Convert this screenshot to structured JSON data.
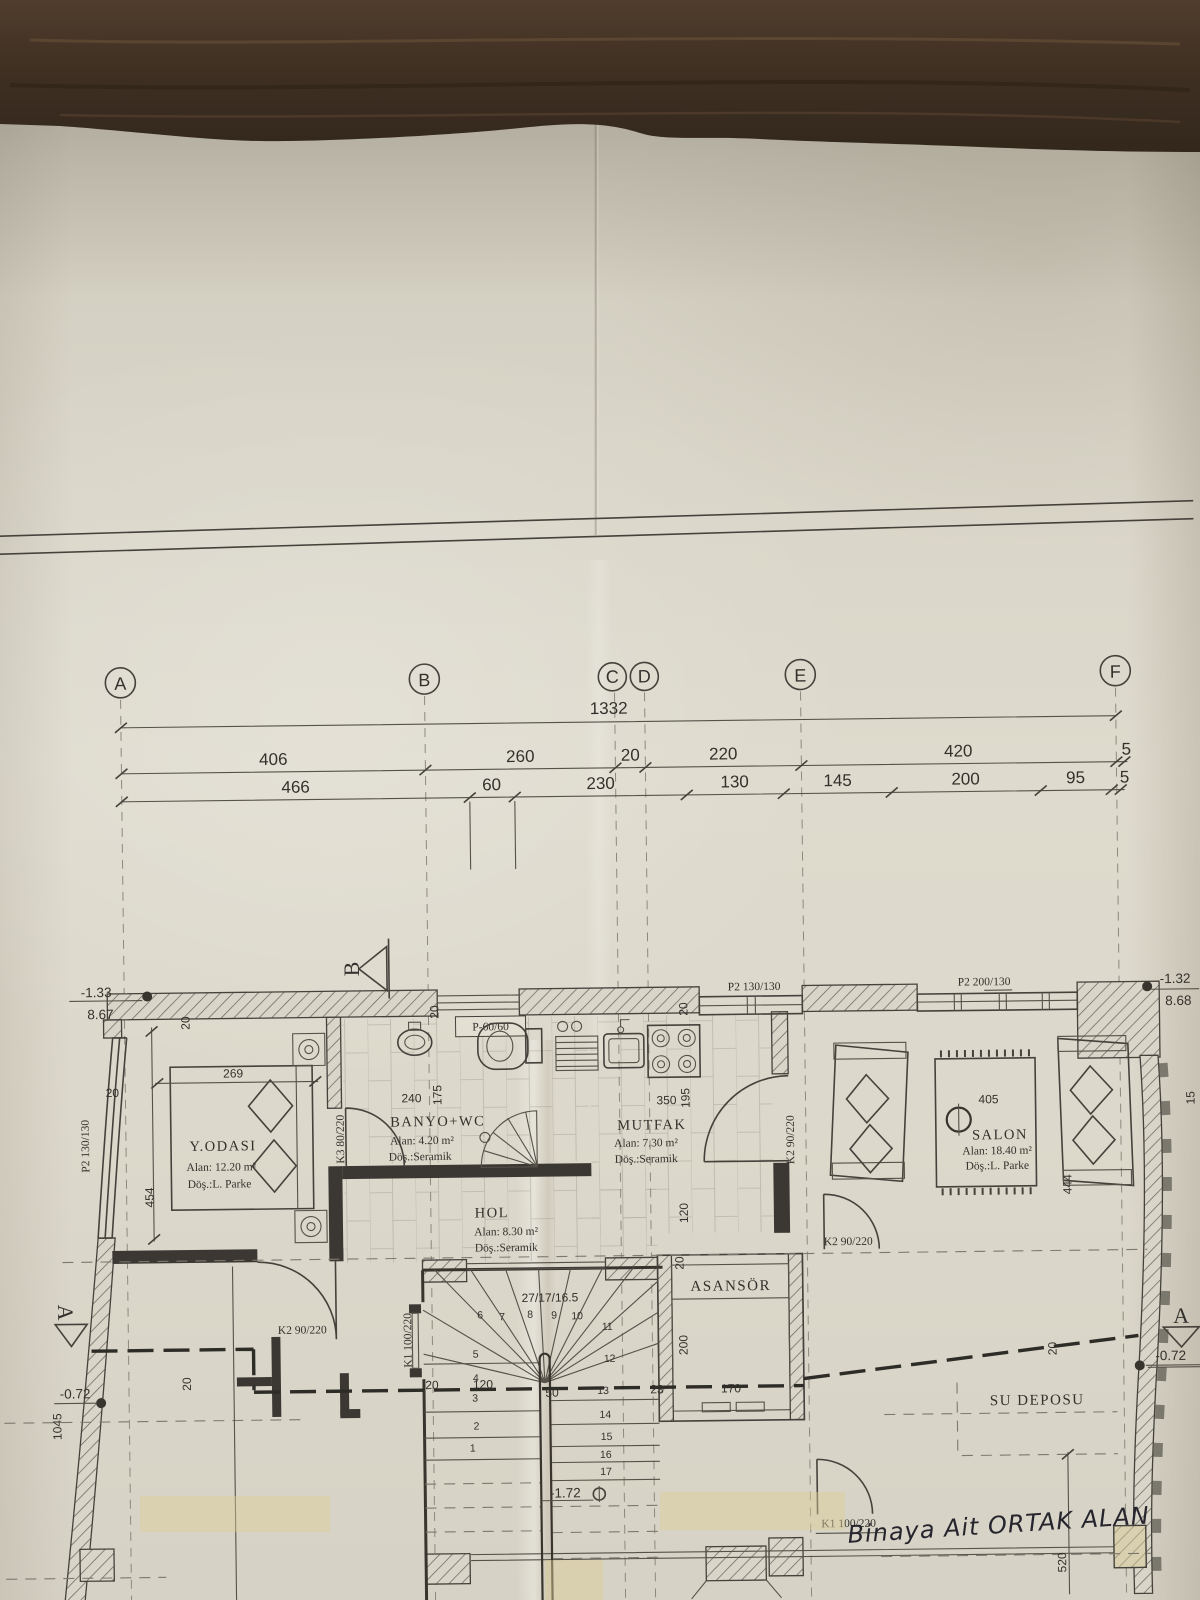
{
  "grid": {
    "axes": [
      "A",
      "B",
      "C",
      "D",
      "E",
      "F"
    ],
    "total": "1332",
    "row2": [
      "406",
      "260",
      "20",
      "220",
      "420",
      "5"
    ],
    "row3": [
      "466",
      "60",
      "230",
      "130",
      "145",
      "200",
      "95",
      "5"
    ]
  },
  "elevations": {
    "top_left_minus": "-1.33",
    "top_left_plus": "8.67",
    "top_right_minus": "-1.32",
    "top_right_plus": "8.68",
    "left": "-0.72",
    "right": "-0.72",
    "stair": "-1.72"
  },
  "sections": {
    "b": "B",
    "a_left": "A",
    "a_right": "A"
  },
  "rooms": {
    "y_odasi": {
      "name": "Y.ODASI",
      "area": "Alan: 12.20 m²",
      "floor": "Döş.:L. Parke"
    },
    "banyo": {
      "name": "BANYO+WC",
      "area": "Alan: 4.20 m²",
      "floor": "Döş.:Seramik"
    },
    "mutfak": {
      "name": "MUTFAK",
      "area": "Alan: 7.30 m²",
      "floor": "Döş.:Seramik"
    },
    "hol": {
      "name": "HOL",
      "area": "Alan: 8.30 m²",
      "floor": "Döş.:Seramik"
    },
    "salon": {
      "name": "SALON",
      "area": "Alan: 18.40 m²",
      "floor": "Döş.:L. Parke"
    },
    "asansor": {
      "name": "ASANSÖR"
    },
    "su_deposu": {
      "name": "SU DEPOSU"
    }
  },
  "dims": {
    "bedroom_w": "269",
    "bedroom_h": "454",
    "bedroom_wall": "20",
    "bedroom_top": "20",
    "banyo_w": "240",
    "banyo_h": "175",
    "banyo_top": "20",
    "mutfak_w": "350",
    "mutfak_h": "195",
    "mutfak_top": "20",
    "corridor": "120",
    "corridor_wall": "20",
    "salon_w": "405",
    "salon_h": "444",
    "salon_wall": "15",
    "asansor_w": "170",
    "asansor_h": "200",
    "asansor_gap": "23",
    "left_v": "1045",
    "left_wall": "20",
    "right_wall": "20",
    "su_v": "520"
  },
  "stairs": {
    "spec": "27/17/16.5",
    "dim_a": "20",
    "dim_b": "120",
    "dim_c": "50",
    "numbers": [
      "1",
      "2",
      "3",
      "4",
      "5",
      "6",
      "7",
      "8",
      "9",
      "10",
      "11",
      "12",
      "13",
      "14",
      "15",
      "16",
      "17"
    ]
  },
  "doors": {
    "k1_stair": "K1 100/220",
    "k1_bottom": "K1 100/220",
    "k2_bedroom": "K2 90/220",
    "k2_kitchen": "K2 90/220",
    "k2_salon": "K2 90/220",
    "k3_banyo": "K3 80/220"
  },
  "windows": {
    "p60": "P-60/60",
    "p2_kitchen": "P2 130/130",
    "p2_left": "P2 130/130",
    "p2_salon": "P2 200/130"
  },
  "note": {
    "handwritten": "Binaya Ait ORTAK ALAN"
  }
}
